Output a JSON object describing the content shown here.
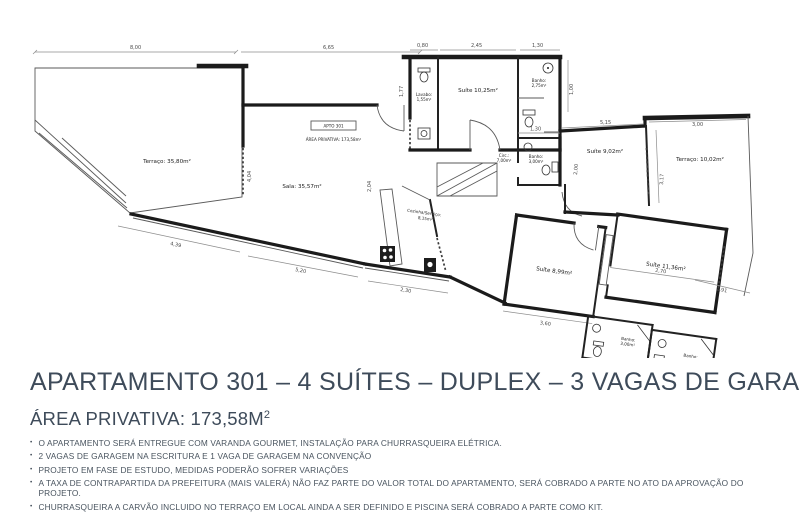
{
  "plan": {
    "unit_box_label": "APTO 301",
    "unit_area_label": "ÁREA PRIVATIVA: 173,58m²",
    "rooms": {
      "terraco1": "Terraço: 35,80m²",
      "sala": "Sala: 35,57m²",
      "cozinha_l1": "Cozinha/Serviço:",
      "cozinha_l2": "8,15m²",
      "suite1": "Suíte 10,25m²",
      "lavabo_l1": "Lavabo:",
      "lavabo_l2": "1,55m²",
      "banho1_l1": "Banho:",
      "banho1_l2": "2,75m²",
      "circ_l1": "Circ.:",
      "circ_l2": "7,00m²",
      "banho2_l1": "Banho:",
      "banho2_l2": "3,00m²",
      "suite2": "Suíte 9,02m²",
      "terraco2": "Terraço: 10,02m²",
      "suite3": "Suíte 8,99m²",
      "suite4": "Suíte 11,36m²",
      "banho3_l1": "Banho:",
      "banho3_l2": "3,00m²",
      "banho4_l1": "Banho:",
      "banho4_l2": "2,90m²"
    },
    "dims": {
      "d1": "8,00",
      "d2": "6,65",
      "d3": "0,80",
      "d4": "2,45",
      "d5": "1,30",
      "d6": "1,77",
      "d7": "1,00",
      "d8": "1,30",
      "d9": "5,15",
      "d10": "3,00",
      "d11": "3,17",
      "d12": "2,00",
      "d13": "4,04",
      "d14": "2,04",
      "d15": "4,39",
      "d16": "5,20",
      "d17": "2,30",
      "d18": "3,60",
      "d19": "2,70",
      "d20": "1,91",
      "d21": "2,95",
      "d22": "2,90"
    }
  },
  "info": {
    "title": "APARTAMENTO 301 – 4 SUÍTES – DUPLEX – 3 VAGAS DE GARAGEM*",
    "area_label": "ÁREA PRIVATIVA: 173,58M",
    "area_sup": "2",
    "bullet_char": "•",
    "bullets": [
      "O APARTAMENTO SERÁ ENTREGUE COM VARANDA GOURMET, INSTALAÇÃO PARA CHURRASQUEIRA ELÉTRICA.",
      "2 VAGAS DE GARAGEM NA ESCRITURA E 1 VAGA DE GARAGEM NA CONVENÇÃO",
      "PROJETO EM FASE DE ESTUDO, MEDIDAS PODERÃO SOFRER VARIAÇÕES",
      "A TAXA DE CONTRAPARTIDA DA PREFEITURA (MAIS VALERÁ) NÃO FAZ PARTE DO VALOR TOTAL DO APARTAMENTO, SERÁ COBRADO A PARTE NO ATO DA APROVAÇÃO DO PROJETO.",
      "CHURRASQUEIRA A CARVÃO INCLUIDO NO TERRAÇO EM LOCAL AINDA A SER DEFINIDO E PISCINA SERÁ COBRADO A PARTE COMO KIT."
    ]
  },
  "colors": {
    "heading": "#3e4b5a",
    "body_text": "#49545f",
    "wall": "#1b1b1b",
    "line": "#5a5a5a"
  }
}
